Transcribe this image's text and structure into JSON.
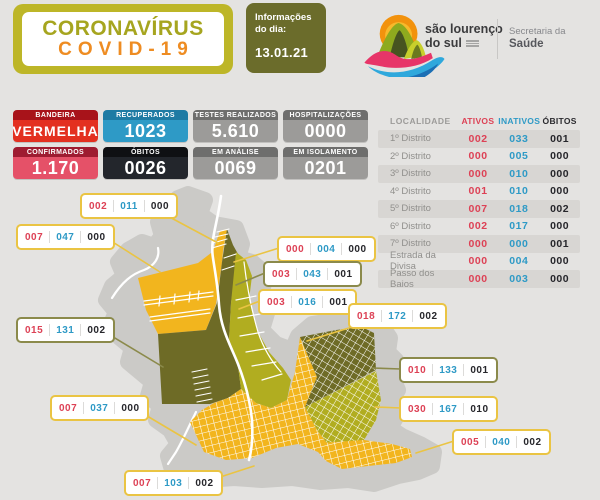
{
  "header": {
    "badge": {
      "line1": "CORONAVÍRUS",
      "line2": "COVID-19"
    },
    "info": {
      "label_line1": "Informações",
      "label_line2": "do dia:",
      "date": "13.01.21"
    },
    "city": {
      "name_line1": "são lourenço",
      "name_line2": "do sul"
    },
    "secretariat": {
      "line1": "Secretaria da",
      "line2": "Saúde"
    }
  },
  "stats": [
    {
      "label": "BANDEIRA",
      "value": "VERMELHA",
      "header_bg": "#A8131A",
      "body_bg": "#E33020",
      "small_value": true
    },
    {
      "label": "RECUPERADOS",
      "value": "1023",
      "header_bg": "#1E7BA4",
      "body_bg": "#2E9AC6",
      "small_value": false
    },
    {
      "label": "TESTES REALIZADOS",
      "value": "5.610",
      "header_bg": "#6E6E6D",
      "body_bg": "#9C9B99",
      "small_value": false
    },
    {
      "label": "HOSPITALIZAÇÕES",
      "value": "0000",
      "header_bg": "#6E6E6D",
      "body_bg": "#9C9B99",
      "small_value": false
    },
    {
      "label": "CONFIRMADOS",
      "value": "1.170",
      "header_bg": "#9E1C31",
      "body_bg": "#E55168",
      "small_value": false
    },
    {
      "label": "ÓBITOS",
      "value": "0026",
      "header_bg": "#0F1013",
      "body_bg": "#23262C",
      "small_value": false
    },
    {
      "label": "EM ANÁLISE",
      "value": "0069",
      "header_bg": "#6E6E6D",
      "body_bg": "#9C9B99",
      "small_value": false
    },
    {
      "label": "EM ISOLAMENTO",
      "value": "0201",
      "header_bg": "#6E6E6D",
      "body_bg": "#9C9B99",
      "small_value": false
    }
  ],
  "table": {
    "headers": [
      "LOCALIDADE",
      "ATIVOS",
      "INATIVOS",
      "ÓBITOS"
    ],
    "rows": [
      {
        "localidade": "1º Distrito",
        "ativos": "002",
        "inativos": "033",
        "obitos": "001"
      },
      {
        "localidade": "2º Distrito",
        "ativos": "000",
        "inativos": "005",
        "obitos": "000"
      },
      {
        "localidade": "3º Distrito",
        "ativos": "000",
        "inativos": "010",
        "obitos": "000"
      },
      {
        "localidade": "4º Distrito",
        "ativos": "001",
        "inativos": "010",
        "obitos": "000"
      },
      {
        "localidade": "5º Distrito",
        "ativos": "007",
        "inativos": "018",
        "obitos": "002"
      },
      {
        "localidade": "6º Distrito",
        "ativos": "002",
        "inativos": "017",
        "obitos": "000"
      },
      {
        "localidade": "7º Distrito",
        "ativos": "000",
        "inativos": "000",
        "obitos": "001"
      },
      {
        "localidade": "Estrada da Divisa",
        "ativos": "000",
        "inativos": "004",
        "obitos": "000"
      },
      {
        "localidade": "Passo dos Baios",
        "ativos": "000",
        "inativos": "003",
        "obitos": "000"
      }
    ]
  },
  "map": {
    "callouts": [
      {
        "ativos": "002",
        "inativos": "011",
        "obitos": "000",
        "accent": "#EAC443",
        "x": 80,
        "y": 193
      },
      {
        "ativos": "007",
        "inativos": "047",
        "obitos": "000",
        "accent": "#EAC443",
        "x": 16,
        "y": 224
      },
      {
        "ativos": "000",
        "inativos": "004",
        "obitos": "000",
        "accent": "#EAC443",
        "x": 277,
        "y": 236
      },
      {
        "ativos": "003",
        "inativos": "043",
        "obitos": "001",
        "accent": "#8B8A4B",
        "x": 263,
        "y": 261
      },
      {
        "ativos": "003",
        "inativos": "016",
        "obitos": "001",
        "accent": "#EAC443",
        "x": 258,
        "y": 289
      },
      {
        "ativos": "018",
        "inativos": "172",
        "obitos": "002",
        "accent": "#EAC443",
        "x": 348,
        "y": 303
      },
      {
        "ativos": "015",
        "inativos": "131",
        "obitos": "002",
        "accent": "#8B8A4B",
        "x": 16,
        "y": 317
      },
      {
        "ativos": "010",
        "inativos": "133",
        "obitos": "001",
        "accent": "#8B8A4B",
        "x": 399,
        "y": 357
      },
      {
        "ativos": "030",
        "inativos": "167",
        "obitos": "010",
        "accent": "#EAC443",
        "x": 399,
        "y": 396
      },
      {
        "ativos": "005",
        "inativos": "040",
        "obitos": "002",
        "accent": "#EAC443",
        "x": 452,
        "y": 429
      },
      {
        "ativos": "007",
        "inativos": "037",
        "obitos": "000",
        "accent": "#EAC443",
        "x": 50,
        "y": 395
      },
      {
        "ativos": "007",
        "inativos": "103",
        "obitos": "002",
        "accent": "#EAC443",
        "x": 124,
        "y": 470
      }
    ]
  },
  "colors": {
    "background": "#E4E3E1",
    "map_gray": "#CBCAC7",
    "district_yellow": "#F2B51E",
    "district_dark_olive": "#6E6B26",
    "district_green": "#B1AD20",
    "accent_red": "#DD4155",
    "accent_blue": "#2E9AC6",
    "accent_dark": "#26262B",
    "leader_yellow": "#EAC443",
    "leader_olive": "#8B8A4B"
  }
}
